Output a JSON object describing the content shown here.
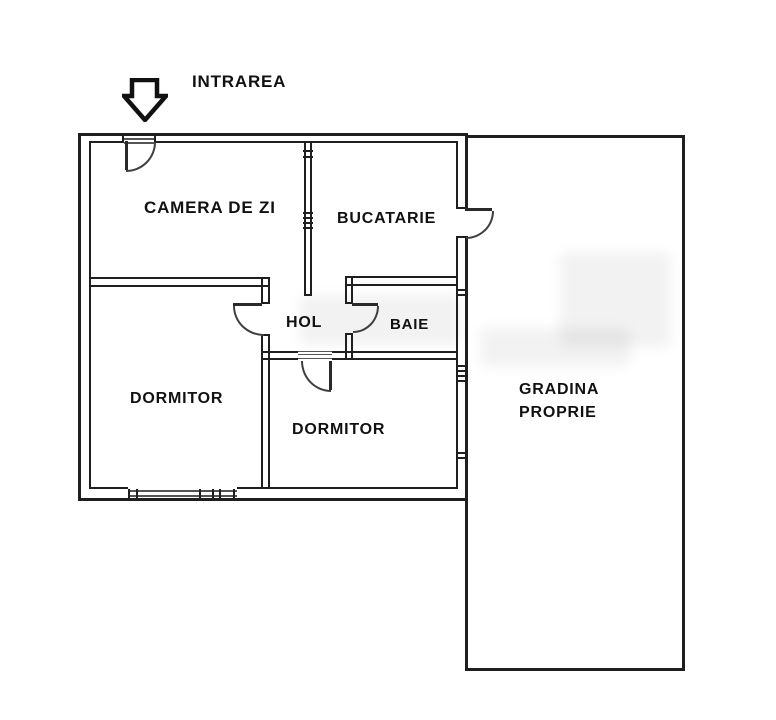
{
  "title": "Apartment floor plan",
  "colors": {
    "background": "#ffffff",
    "wall": "#1f1f1f",
    "door_arc": "#3f3f3f",
    "text": "#111111"
  },
  "icons": {
    "entrance_arrow": "down-arrow-outline"
  },
  "labels": {
    "entrance": "INTRAREA",
    "living_room": "CAMERA DE ZI",
    "kitchen": "BUCATARIE",
    "hall": "HOL",
    "bathroom": "BAIE",
    "bedroom_left": "DORMITOR",
    "bedroom_bottom": "DORMITOR",
    "garden": "GRADINA PROPRIE",
    "garden_line1": "GRADINA",
    "garden_line2": "PROPRIE"
  }
}
